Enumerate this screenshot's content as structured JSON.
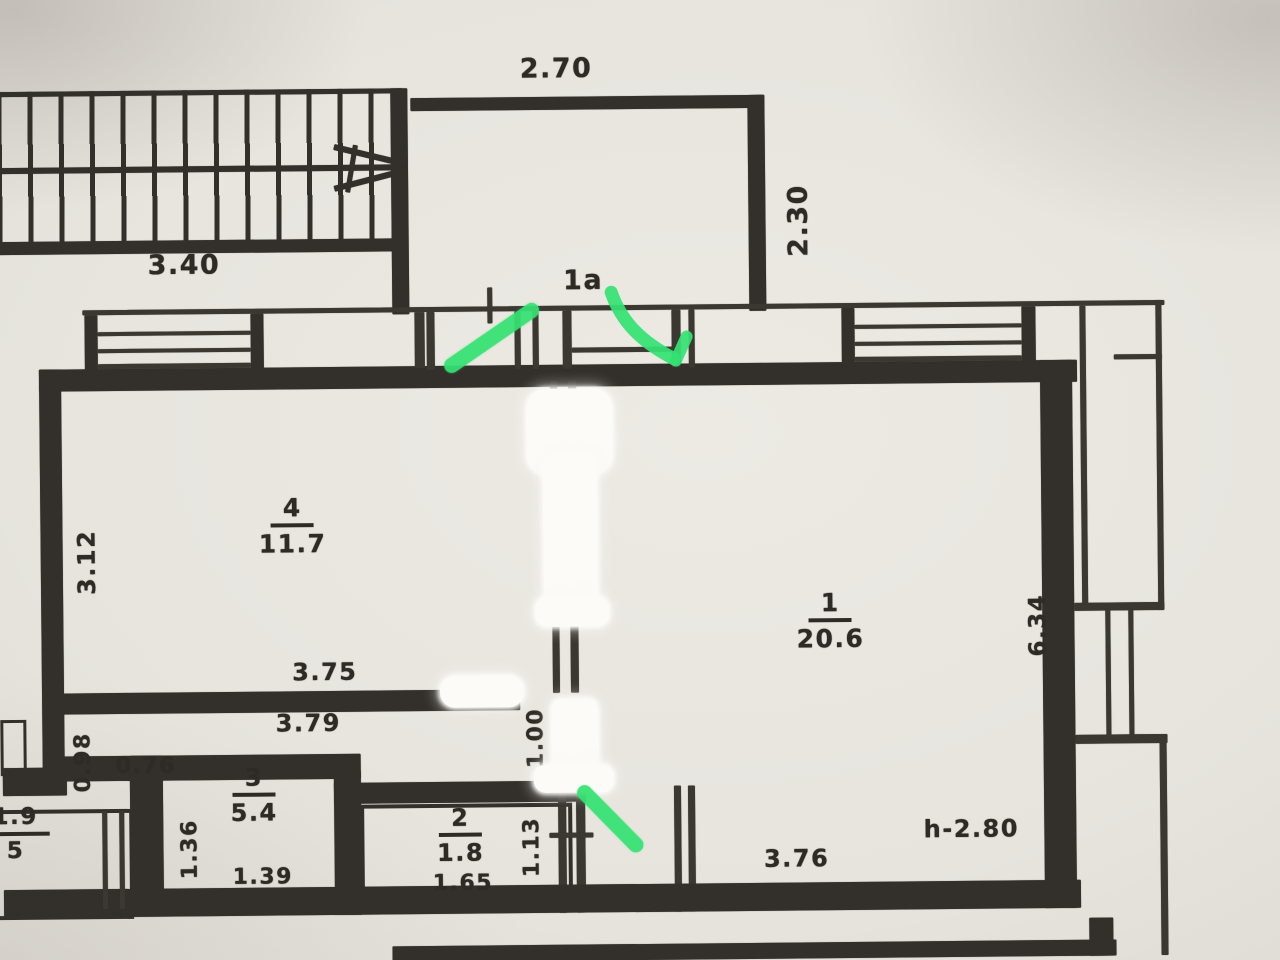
{
  "plan": {
    "rooms": [
      {
        "number": "1",
        "area": "20.6"
      },
      {
        "number": "2",
        "area": "1.8"
      },
      {
        "number": "3",
        "area": "5.4"
      },
      {
        "number": "4",
        "area": "11.7"
      }
    ],
    "porch_label": "1a",
    "ceiling_height": "h-2.80",
    "dimensions": {
      "balcony_top": "2.70",
      "stairs": "3.40",
      "balcony_side": "2.30",
      "room4_left": "3.12",
      "room4_bottom": "3.75",
      "corridor": "3.79",
      "corridor_left": "0.98",
      "corridor_jog": "0.76",
      "room3_left": "1.36",
      "room3_bottom": "1.39",
      "room2_bottom": "1.65",
      "room2_right": "1.13",
      "hall": "1.00",
      "room1_bottom": "3.76",
      "room1_right": "6.34"
    },
    "partial_edge_labels": {
      "top": "1.9",
      "bottom": "5"
    }
  },
  "annotations": {
    "highlighter_color": "#34e272",
    "whiteout_color": "#fcfbf8",
    "ink_color": "#33302b",
    "paper_color": "#e7e4de"
  }
}
